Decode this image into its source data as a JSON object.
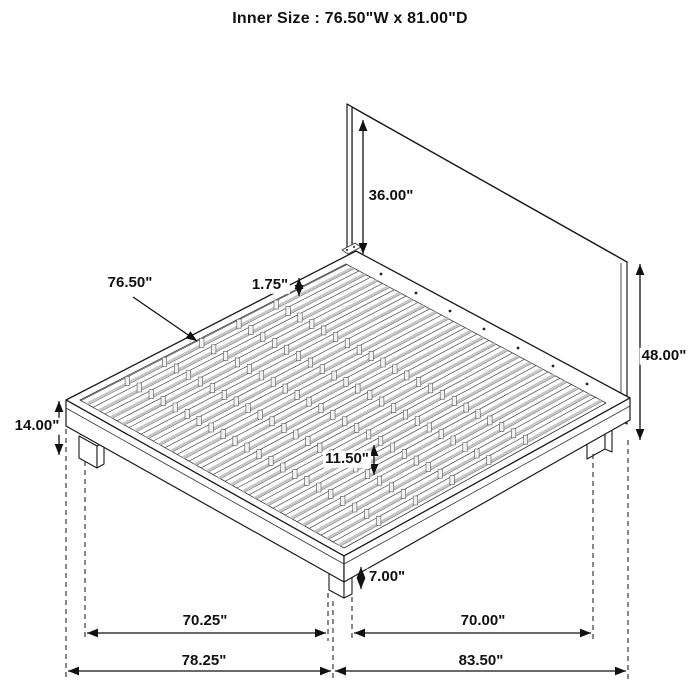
{
  "title": "Inner Size : 76.50\"W x 81.00\"D",
  "dimensions": {
    "headboard_above_platform": "36.00\"",
    "slat_area_width": "76.50\"",
    "slat_gap": "1.75\"",
    "headboard_height": "48.00\"",
    "platform_height": "14.00\"",
    "center_support_spacing": "11.50\"",
    "leg_height": "7.00\"",
    "front_leg_span": "70.25\"",
    "side_leg_span": "70.00\"",
    "overall_width": "78.25\"",
    "overall_depth": "83.50\""
  }
}
